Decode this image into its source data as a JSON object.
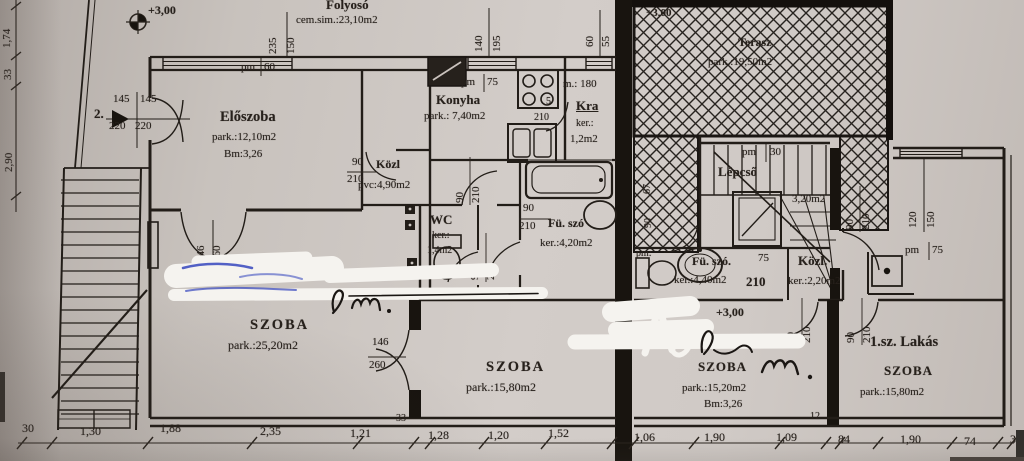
{
  "rooms": {
    "folyoso": {
      "name": "Folyosó",
      "area": "cem.sim.:23,10m2"
    },
    "eloszoba": {
      "name": "Előszoba",
      "area": "park.:12,10m2",
      "bm": "Bm:3,26"
    },
    "konyha": {
      "name": "Konyha",
      "area": "park.: 7,40m2"
    },
    "kra": {
      "name": "Kra",
      "ker": "ker.:",
      "area": "1,2m2"
    },
    "kozl_left": {
      "name": "Közl",
      "area": "pvc:4,90m2"
    },
    "wc": {
      "name": "WC",
      "ker": "ker.:",
      "area": "1,4m2"
    },
    "furdo_left": {
      "name": "Fü. szó",
      "area": "ker.:4,20m2"
    },
    "szoba_nagy": {
      "name": "SZOBA",
      "area": "park.:25,20m2"
    },
    "szoba_kozep": {
      "name": "SZOBA",
      "area": "park.:15,80m2"
    },
    "terasz": {
      "name": "Terasz",
      "area": "park.:19,50m2"
    },
    "lepcso": {
      "name": "Lépcső",
      "area": "3,20m2"
    },
    "furdo_right": {
      "name": "Fü. szó.",
      "num": "75",
      "area": "ker.:4,40m2",
      "door": "210"
    },
    "kozl_right": {
      "name": "Közl.",
      "area": "ker.:2,20m2"
    },
    "szoba_right": {
      "name": "SZOBA",
      "area": "park.:15,20m2",
      "bm": "Bm:3,26"
    },
    "lakas1": {
      "flat": "1.sz. Lakás",
      "name": "SZOBA",
      "area": "park.:15,80m2"
    }
  },
  "levels": {
    "left": "+3,00",
    "terasz": "+3,00",
    "right": "+3,00"
  },
  "entrance": {
    "no": "2."
  },
  "pm": {
    "label": "pm",
    "colon": "pm:",
    "w60": "60",
    "w75": "75",
    "w30": "30",
    "w75r": "75",
    "m180": "m.: 180"
  },
  "dims": {
    "left": [
      "1,74",
      "33",
      "2,90"
    ],
    "bottom": [
      "30",
      "1,30",
      "1,88",
      "2,35",
      "1,21",
      "33",
      "1,28",
      "1,20",
      "1,52",
      "1,06",
      "1,90",
      "1,09",
      "12",
      "84",
      "1,90",
      "74",
      "3"
    ],
    "w235": [
      "235",
      "150"
    ],
    "w140": [
      "140",
      "195"
    ],
    "w60": [
      "60",
      "55"
    ],
    "w120": [
      "120",
      "150"
    ],
    "d145": [
      "145",
      "145",
      "220",
      "220"
    ],
    "d146": [
      "146",
      "260"
    ],
    "d90": "90",
    "d210": "210",
    "d67": "67",
    "d5": "5"
  }
}
